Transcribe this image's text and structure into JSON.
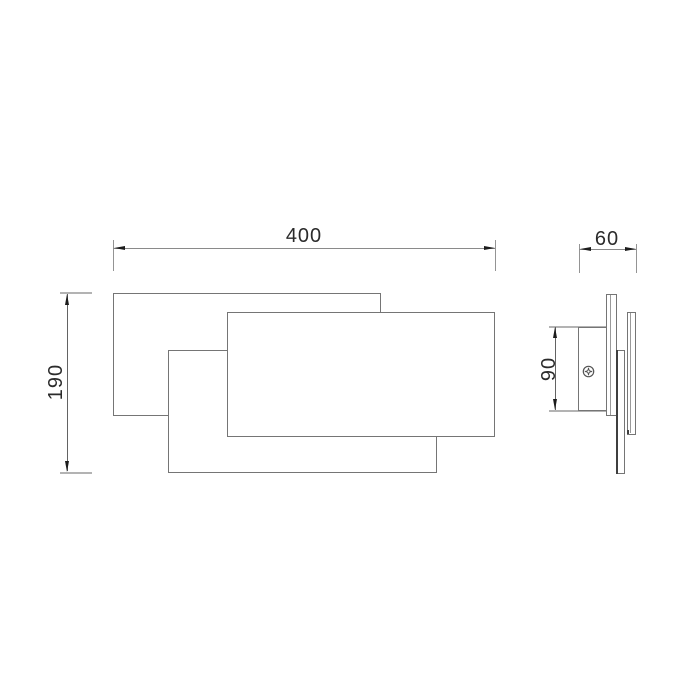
{
  "drawing": {
    "kind": "technical dimension drawing",
    "units_implied": "mm",
    "colors": {
      "object_line": "#757575",
      "dimension_line": "#8a8a8a",
      "pale_extension_line": "#b3b3b3",
      "arrow_and_text": "#1c1c1c",
      "background": "#ffffff"
    }
  },
  "front_view": {
    "width_label": "400",
    "height_label": "190",
    "panel_count": 3
  },
  "side_view": {
    "depth_label": "60",
    "plate_height_label": "90",
    "screw_marker": "phillips-screw-head"
  }
}
